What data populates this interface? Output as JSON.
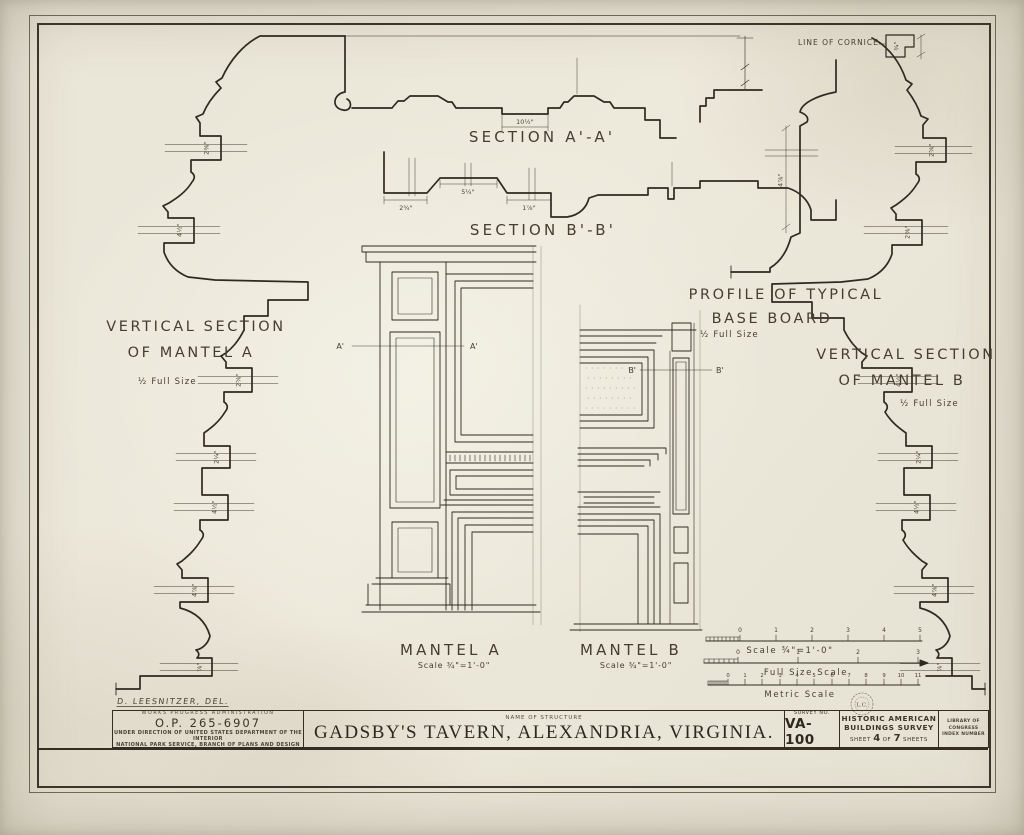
{
  "drawing": {
    "section_aa": {
      "label": "SECTION A'-A'",
      "dim": "10½\""
    },
    "section_bb": {
      "label": "SECTION B'-B'",
      "dims": [
        "2¾\"",
        "5¼\"",
        "1⅞\""
      ]
    },
    "cornice": {
      "label": "LINE OF CORNICE",
      "dim": "¾\""
    },
    "vsa": {
      "line1": "VERTICAL SECTION",
      "line2": "OF MANTEL A",
      "scale": "½ Full Size",
      "dims": [
        "2⅜\"",
        "4½\"",
        "2⅝\"",
        "2¼\"",
        "4½\"",
        "4⅞\"",
        "⅞\""
      ]
    },
    "vsb": {
      "line1": "VERTICAL SECTION",
      "line2": "OF MANTEL B",
      "scale": "½ Full Size",
      "dims": [
        "2⅝\"",
        "2⅜\"",
        "4½\"",
        "2¼\"",
        "4½\"",
        "4⅞\"",
        "⅞\""
      ]
    },
    "baseboard": {
      "line1": "PROFILE OF TYPICAL",
      "line2": "BASE BOARD",
      "scale": "½ Full Size",
      "dim": "4⅞\""
    },
    "mantel_a": {
      "label": "MANTEL A",
      "scale": "Scale ¾\"=1'-0\"",
      "mark": "A'"
    },
    "mantel_b": {
      "label": "MANTEL B",
      "scale": "Scale ¾\"=1'-0\"",
      "mark": "B'"
    }
  },
  "scales": {
    "scale34": {
      "label": "Scale ¾\"=1'-0\"",
      "ticks": [
        "0",
        "1",
        "2",
        "3",
        "4",
        "5"
      ]
    },
    "full_size": {
      "label": "Full Size Scale",
      "ticks": [
        "0",
        "1",
        "2",
        "3"
      ]
    },
    "metric": {
      "label": "Metric Scale",
      "ticks": [
        "0",
        "1",
        "2",
        "3",
        "4",
        "5",
        "6",
        "7",
        "8",
        "9",
        "10",
        "11"
      ]
    },
    "stamp": "L.C."
  },
  "title_block": {
    "delineator": "D. LEESNITZER, DEL.",
    "agency": "WORKS PROGRESS ADMINISTRATION",
    "op_number": "O.P. 265-6907",
    "direction1": "UNDER DIRECTION OF UNITED STATES DEPARTMENT OF THE INTERIOR",
    "direction2": "NATIONAL PARK SERVICE, BRANCH OF PLANS AND DESIGN",
    "name_label": "NAME OF STRUCTURE",
    "structure_name": "GADSBY'S TAVERN, ALEXANDRIA, VIRGINIA.",
    "survey_label": "SURVEY NO.",
    "survey_no": "VA-100",
    "habs1": "HISTORIC AMERICAN",
    "habs2": "BUILDINGS SURVEY",
    "sheet_word": "SHEET",
    "sheet_no": "4",
    "of_word": "OF",
    "sheet_total": "7",
    "sheets_word": "SHEETS",
    "loc1": "LIBRARY OF CONGRESS",
    "loc2": "INDEX NUMBER"
  }
}
